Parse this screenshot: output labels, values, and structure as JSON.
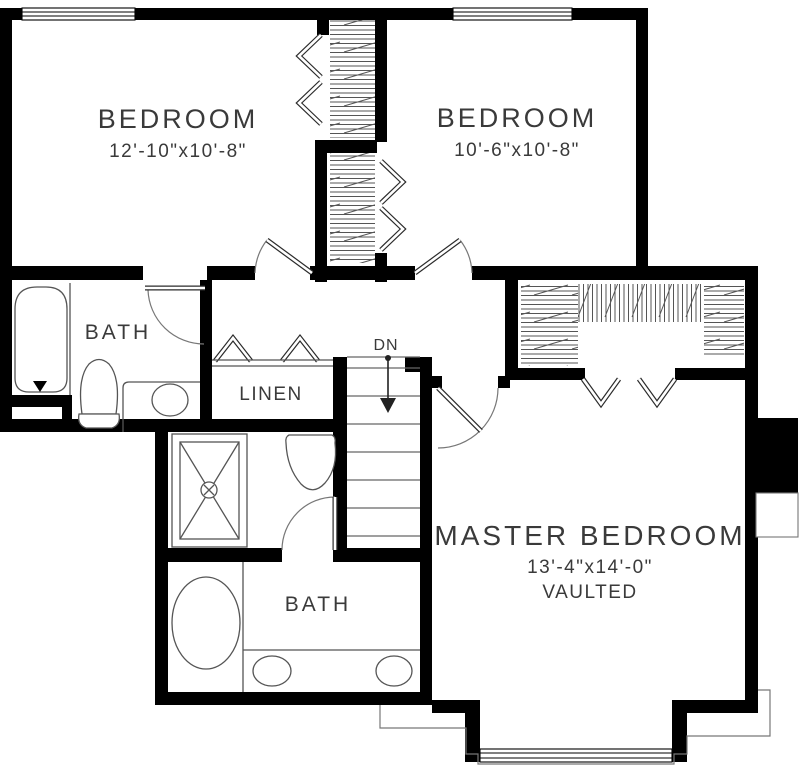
{
  "plan": {
    "title": "Second Floor Plan",
    "rooms": {
      "bedroom1": {
        "name": "BEDROOM",
        "dims": "12'-10\"x10'-8\""
      },
      "bedroom2": {
        "name": "BEDROOM",
        "dims": "10'-6\"x10'-8\""
      },
      "master": {
        "name": "MASTER BEDROOM",
        "dims": "13'-4\"x14'-0\"",
        "note": "VAULTED"
      },
      "hall_bath": {
        "name": "BATH"
      },
      "master_bath": {
        "name": "BATH"
      },
      "linen": {
        "name": "LINEN"
      }
    },
    "stairs": {
      "label": "DN"
    },
    "colors": {
      "wall": "#000000",
      "fixture_line": "#555555",
      "text": "#3a3a3a",
      "background": "#ffffff"
    }
  }
}
